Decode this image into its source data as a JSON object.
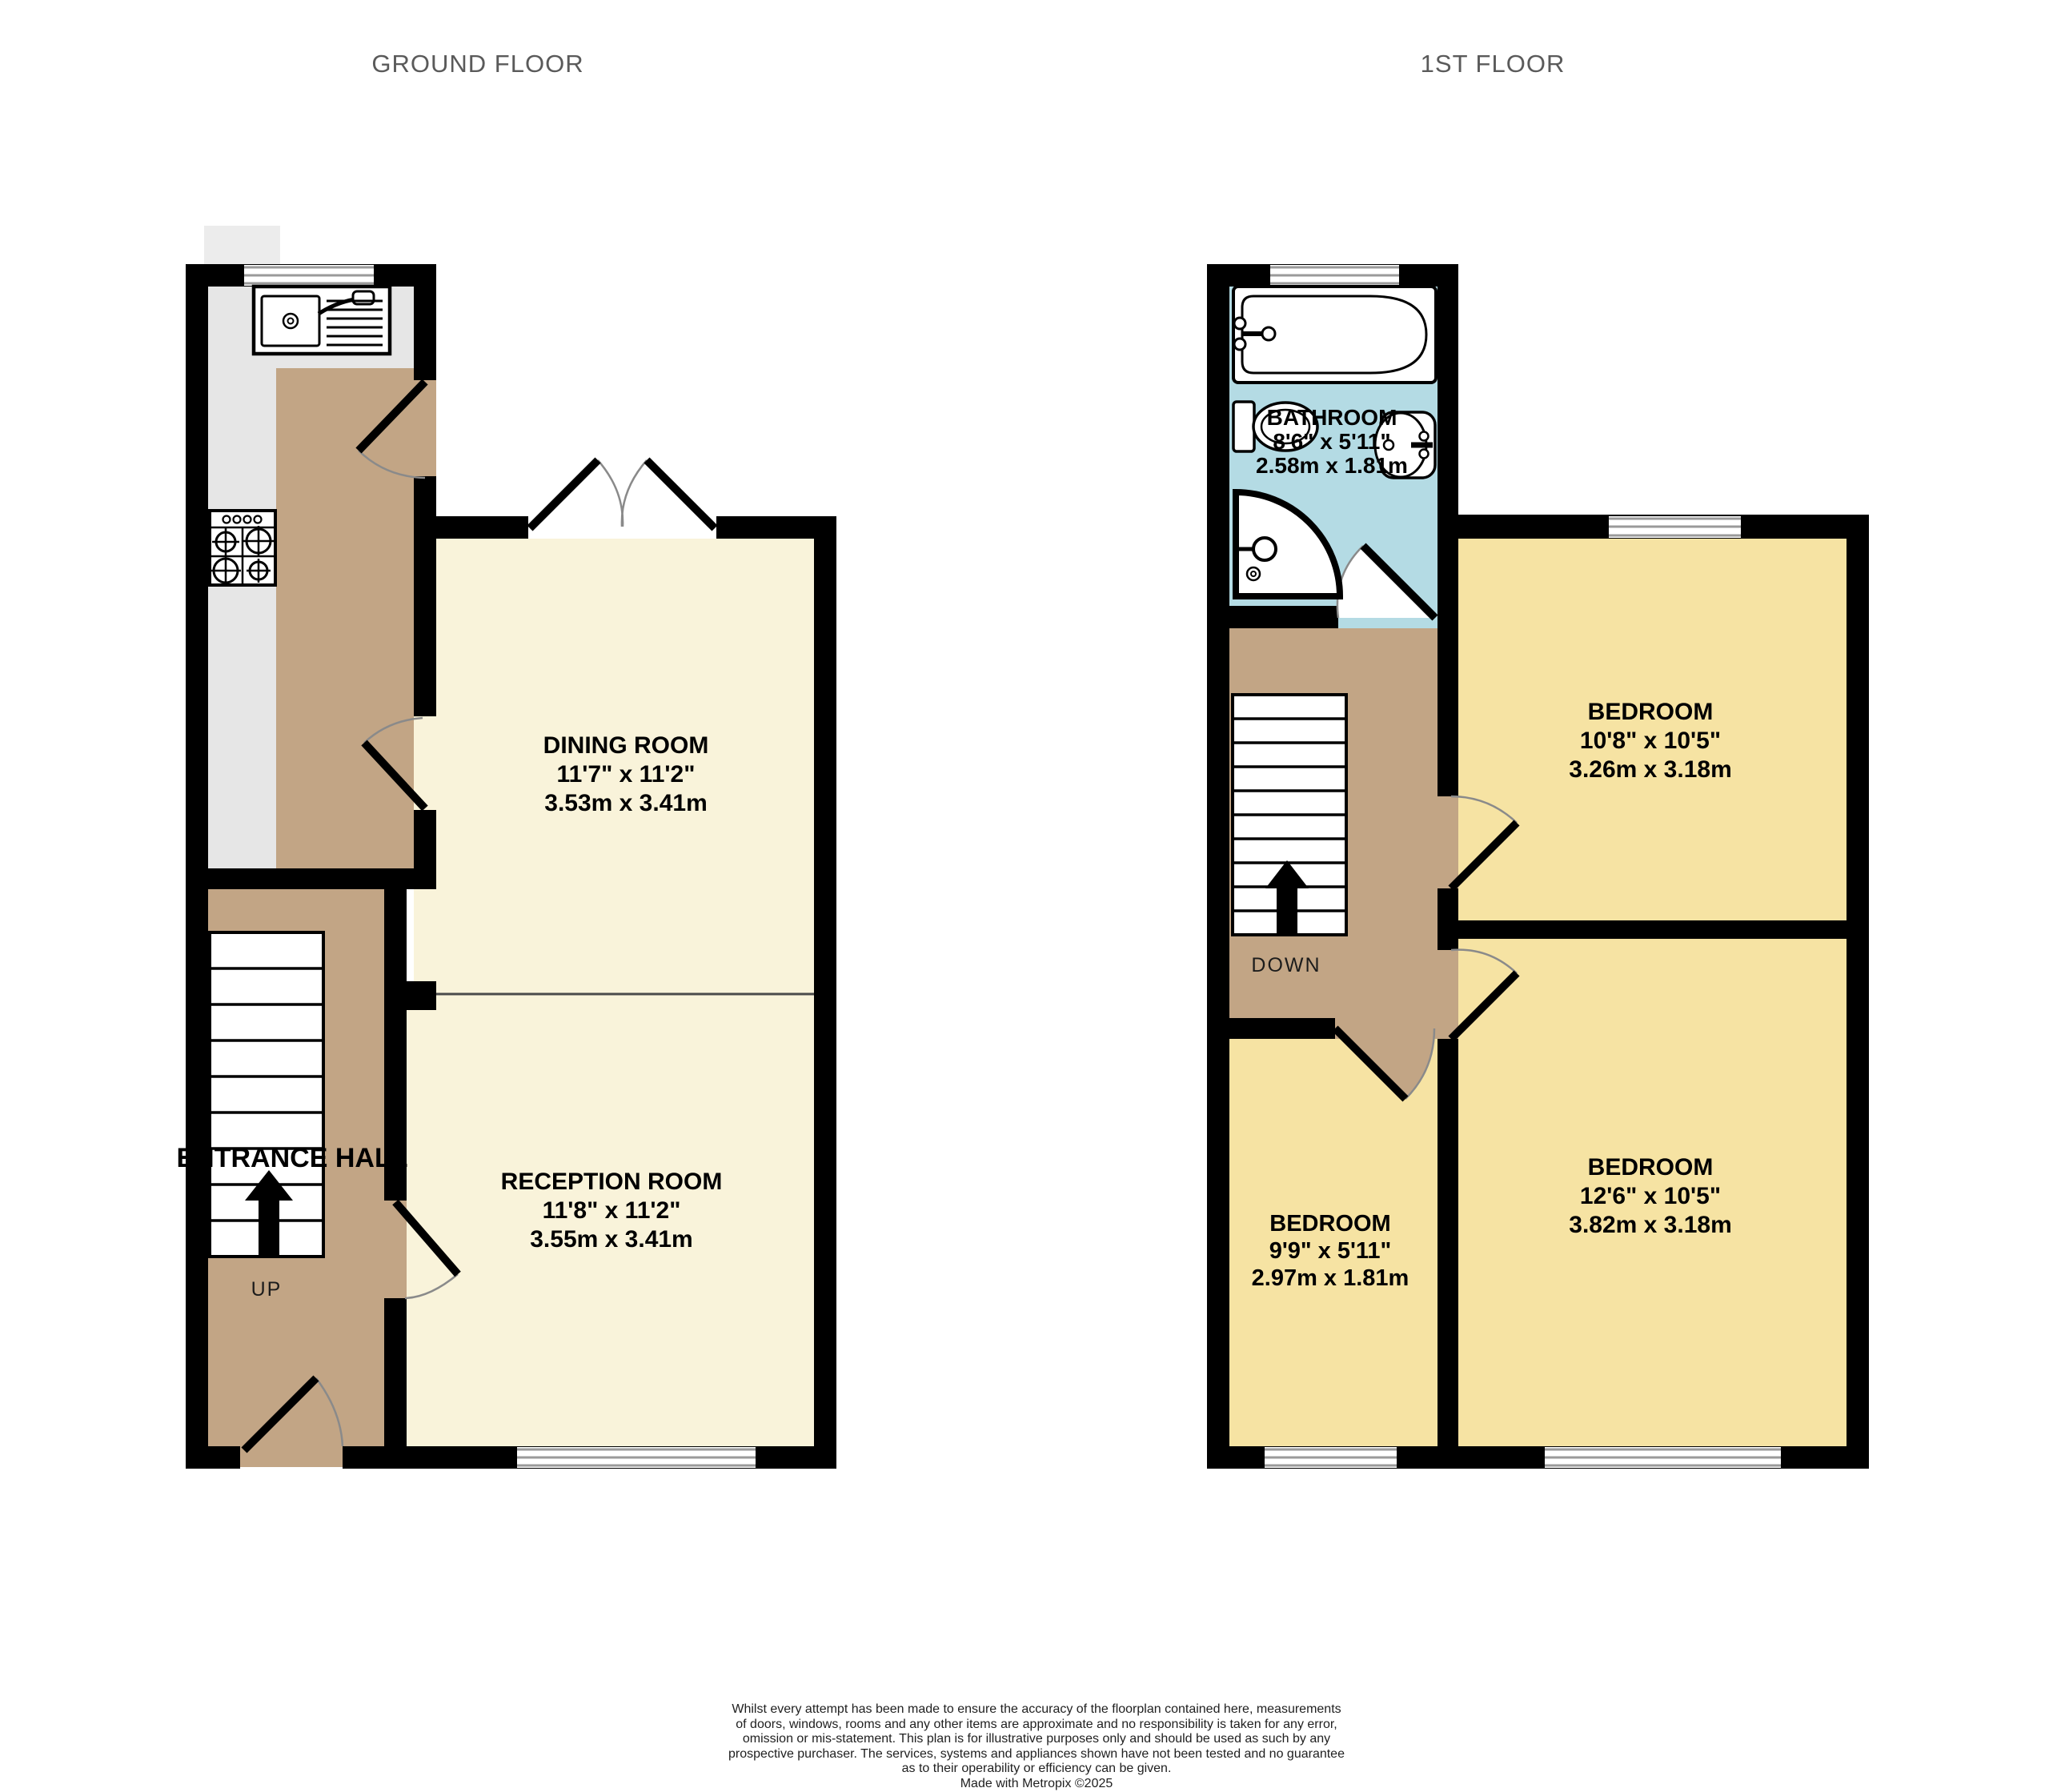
{
  "titles": {
    "ground": "GROUND FLOOR",
    "first": "1ST FLOOR"
  },
  "rooms": {
    "dining": {
      "name": "DINING ROOM",
      "imperial": "11'7\"  x 11'2\"",
      "metric": "3.53m  x 3.41m"
    },
    "reception": {
      "name": "RECEPTION ROOM",
      "imperial": "11'8\"  x 11'2\"",
      "metric": "3.55m  x 3.41m"
    },
    "bathroom": {
      "name": "BATHROOM",
      "imperial": "8'6\"  x 5'11\"",
      "metric": "2.58m  x 1.81m"
    },
    "bedroom1": {
      "name": "BEDROOM",
      "imperial": "10'8\"  x 10'5\"",
      "metric": "3.26m  x 3.18m"
    },
    "bedroom2": {
      "name": "BEDROOM",
      "imperial": "12'6\"  x 10'5\"",
      "metric": "3.82m  x 3.18m"
    },
    "bedroom3": {
      "name": "BEDROOM",
      "imperial": "9'9\"  x 5'11\"",
      "metric": "2.97m  x 1.81m"
    },
    "hall": {
      "name": "ENTRANCE HALL"
    }
  },
  "stairs": {
    "up": "UP",
    "down": "DOWN"
  },
  "disclaimer": {
    "line1": "Whilst every attempt has been made to ensure the accuracy of the floorplan contained here, measurements",
    "line2": "of doors, windows, rooms and any other items are approximate and no responsibility is taken for any error,",
    "line3": "omission or mis-statement. This plan is for illustrative purposes only and should be used as such by any",
    "line4": "prospective purchaser. The services, systems and appliances shown have not been tested and no guarantee",
    "line5": "as to their operability or efficiency can be given.",
    "credit": "Made with Metropix ©2025"
  },
  "colors": {
    "wall": "#000000",
    "kitchen_floor": "#e6e6e6",
    "chimney": "#ececec",
    "hall_tan": "#c2a585",
    "reception_cream": "#f9f3da",
    "bedroom_yellow": "#f6e3a3",
    "bathroom_blue": "#b4dbe4",
    "door_arc": "#8a8a8a",
    "window_line": "#9a9a9a",
    "title_gray": "#5a5a5a"
  }
}
